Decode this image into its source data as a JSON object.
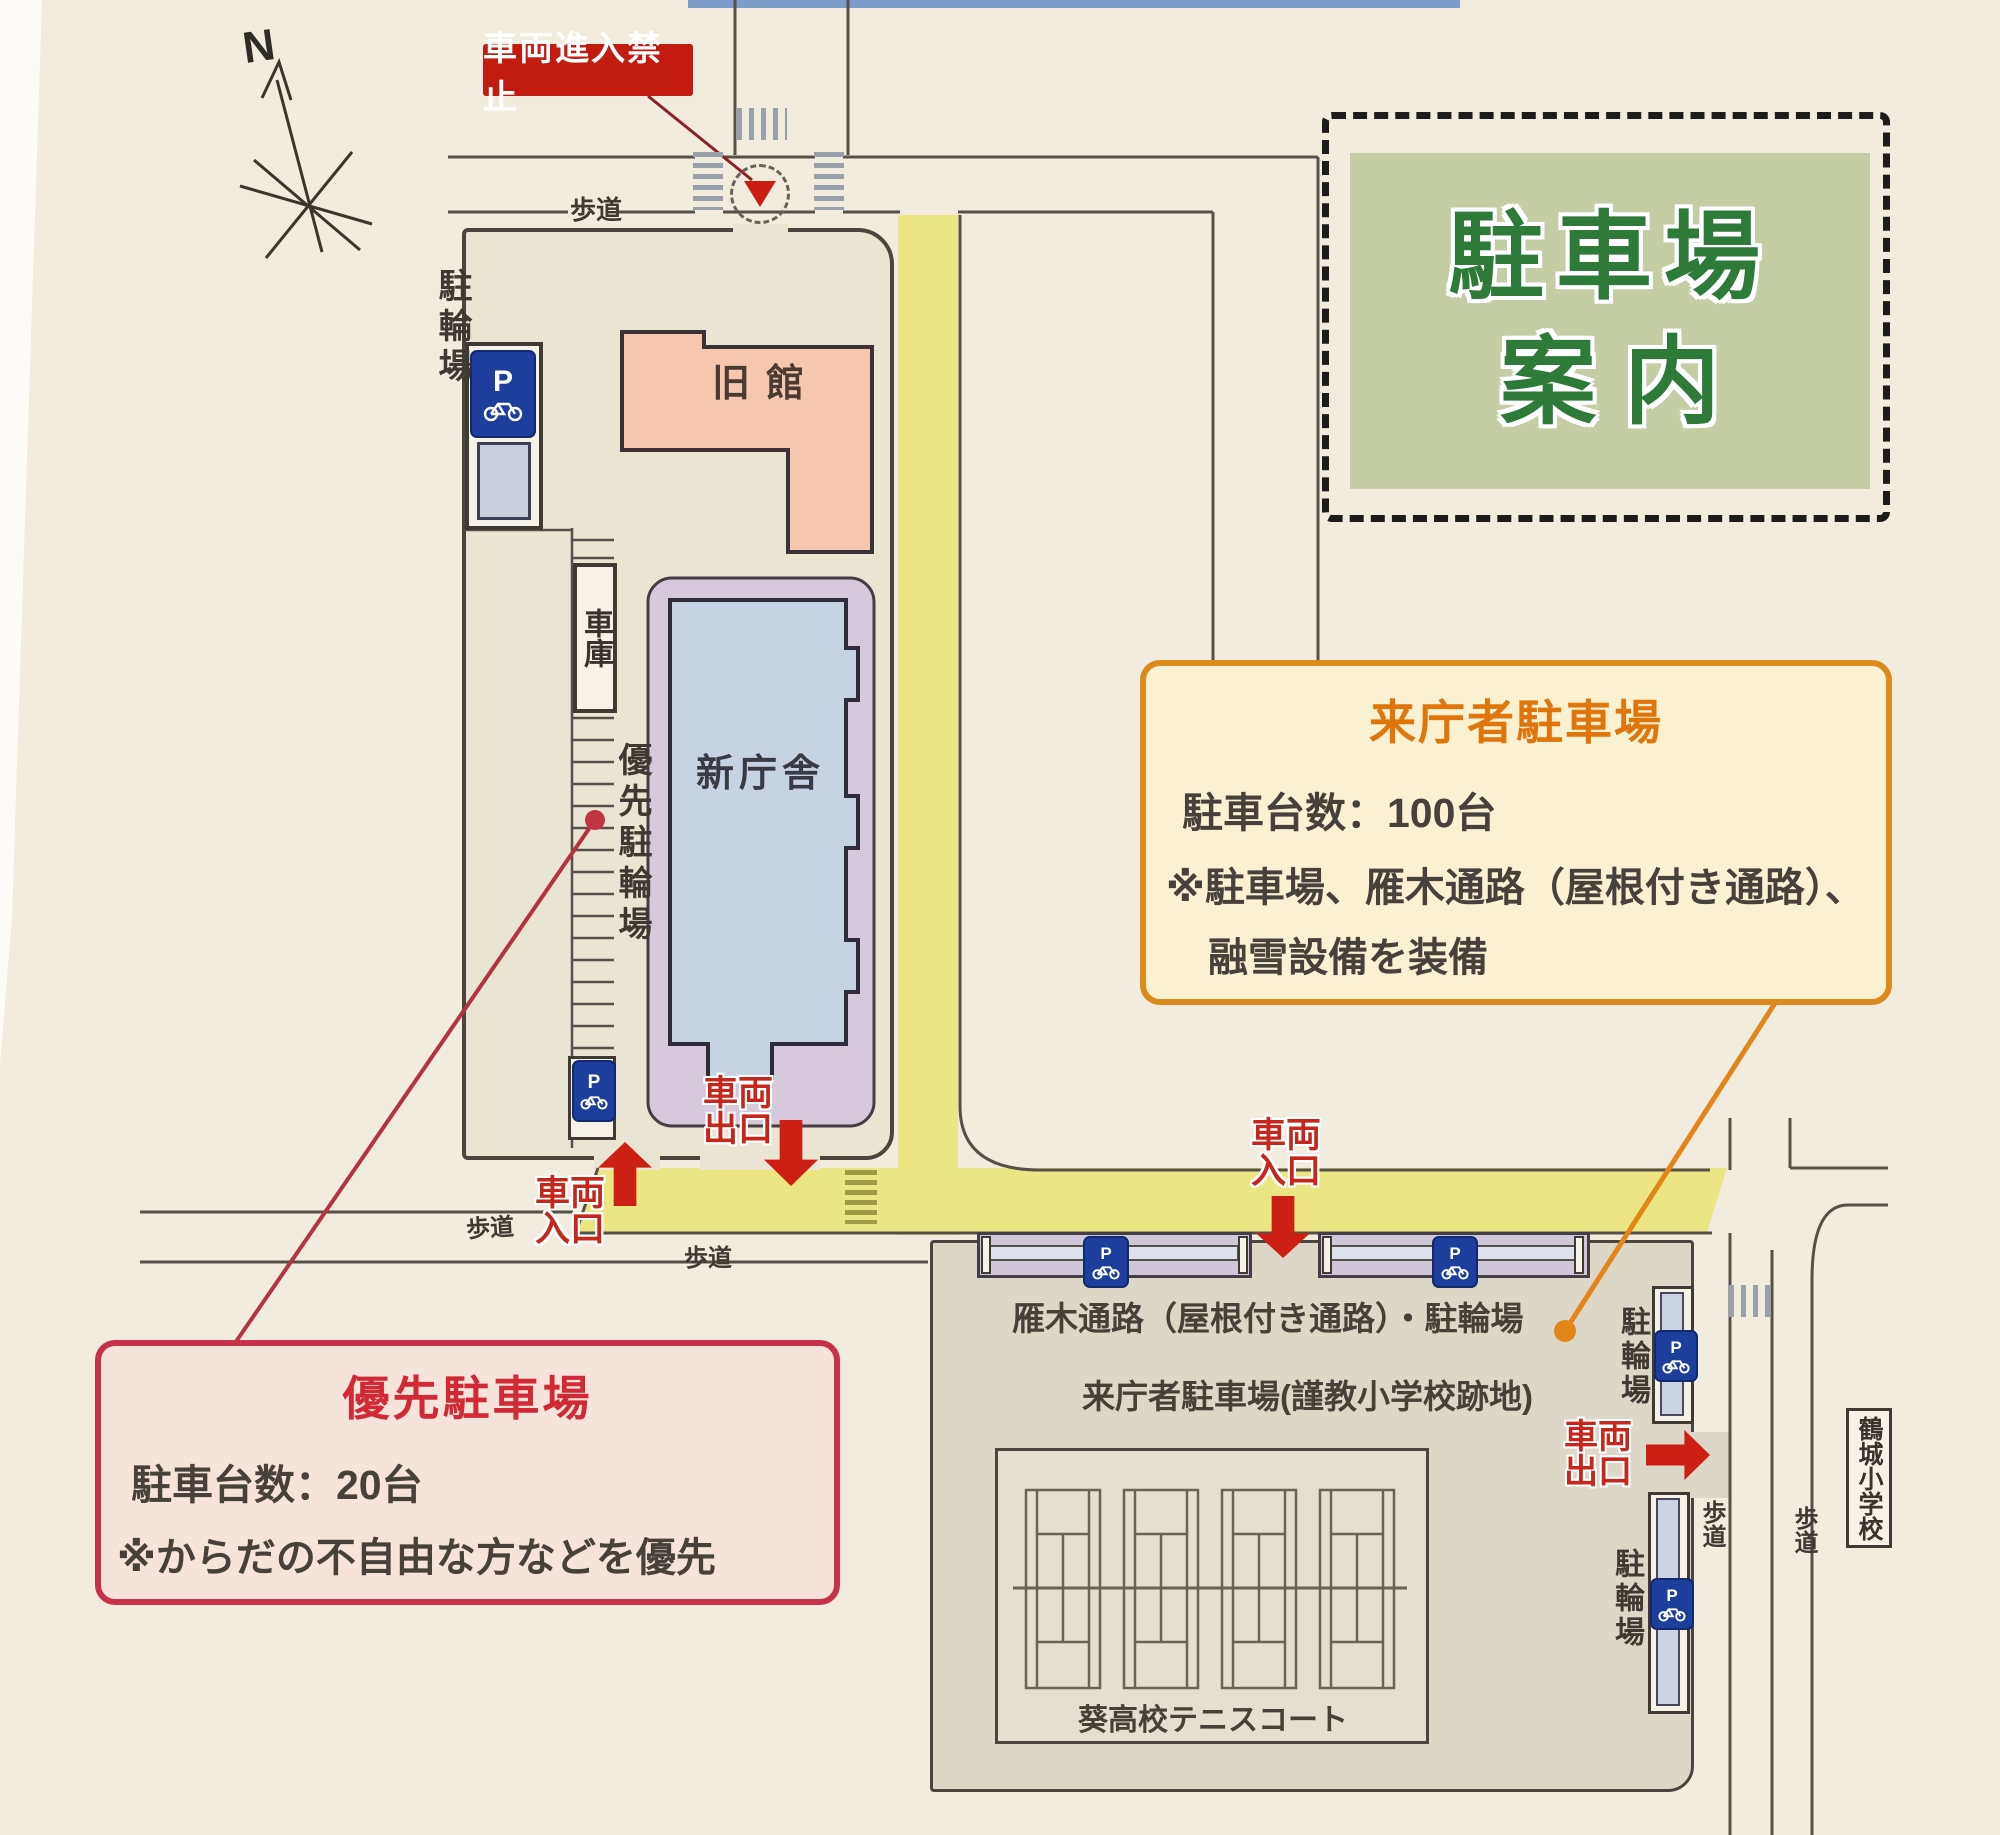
{
  "title_box": {
    "line1": "駐車場",
    "line2": "案内"
  },
  "compass": {
    "north_label": "N"
  },
  "no_entry_sign": {
    "label": "車両進入禁止"
  },
  "labels": {
    "sidewalk": "歩道",
    "bicycle_parking": "駐輪場",
    "garage": "車庫",
    "priority_bicycle_parking": "優先駐輪場",
    "old_building": "旧館",
    "new_building": "新庁舎",
    "gangi_passage": "雁木通路（屋根付き通路）・駐輪場",
    "visitor_parking_area": "来庁者駐車場(謹教小学校跡地)",
    "tennis_court": "葵高校テニスコート",
    "tsurujo_elementary": "鶴城小学校"
  },
  "gates": {
    "entrance_line1": "車両",
    "entrance_line2": "入口",
    "exit_line1": "車両",
    "exit_line2": "出口"
  },
  "p_sign": {
    "letter": "P"
  },
  "callouts": {
    "visitor": {
      "title": "来庁者駐車場",
      "capacity": "駐車台数：100台",
      "note1": "※駐車場、雁木通路（屋根付き通路）、",
      "note2": "融雪設備を装備"
    },
    "priority": {
      "title": "優先駐車場",
      "capacity": "駐車台数：20台",
      "note": "※からだの不自由な方などを優先"
    }
  },
  "colors": {
    "page_bg": "#f2ecdf",
    "site_ground": "#eae4d3",
    "old_building": "#f4c7ae",
    "new_building": "#c7d2e2",
    "canopy": "#d7c9dc",
    "road_yellow": "#ece584",
    "parking_gray": "#dcd7c7",
    "title_green_bg": "#c5cda5",
    "title_green_text": "#2e7a39",
    "accent_red": "#ce1f14",
    "accent_orange": "#dd8a1c",
    "callout_red_border": "#c83248",
    "p_sign_blue": "#1e3e9d"
  }
}
